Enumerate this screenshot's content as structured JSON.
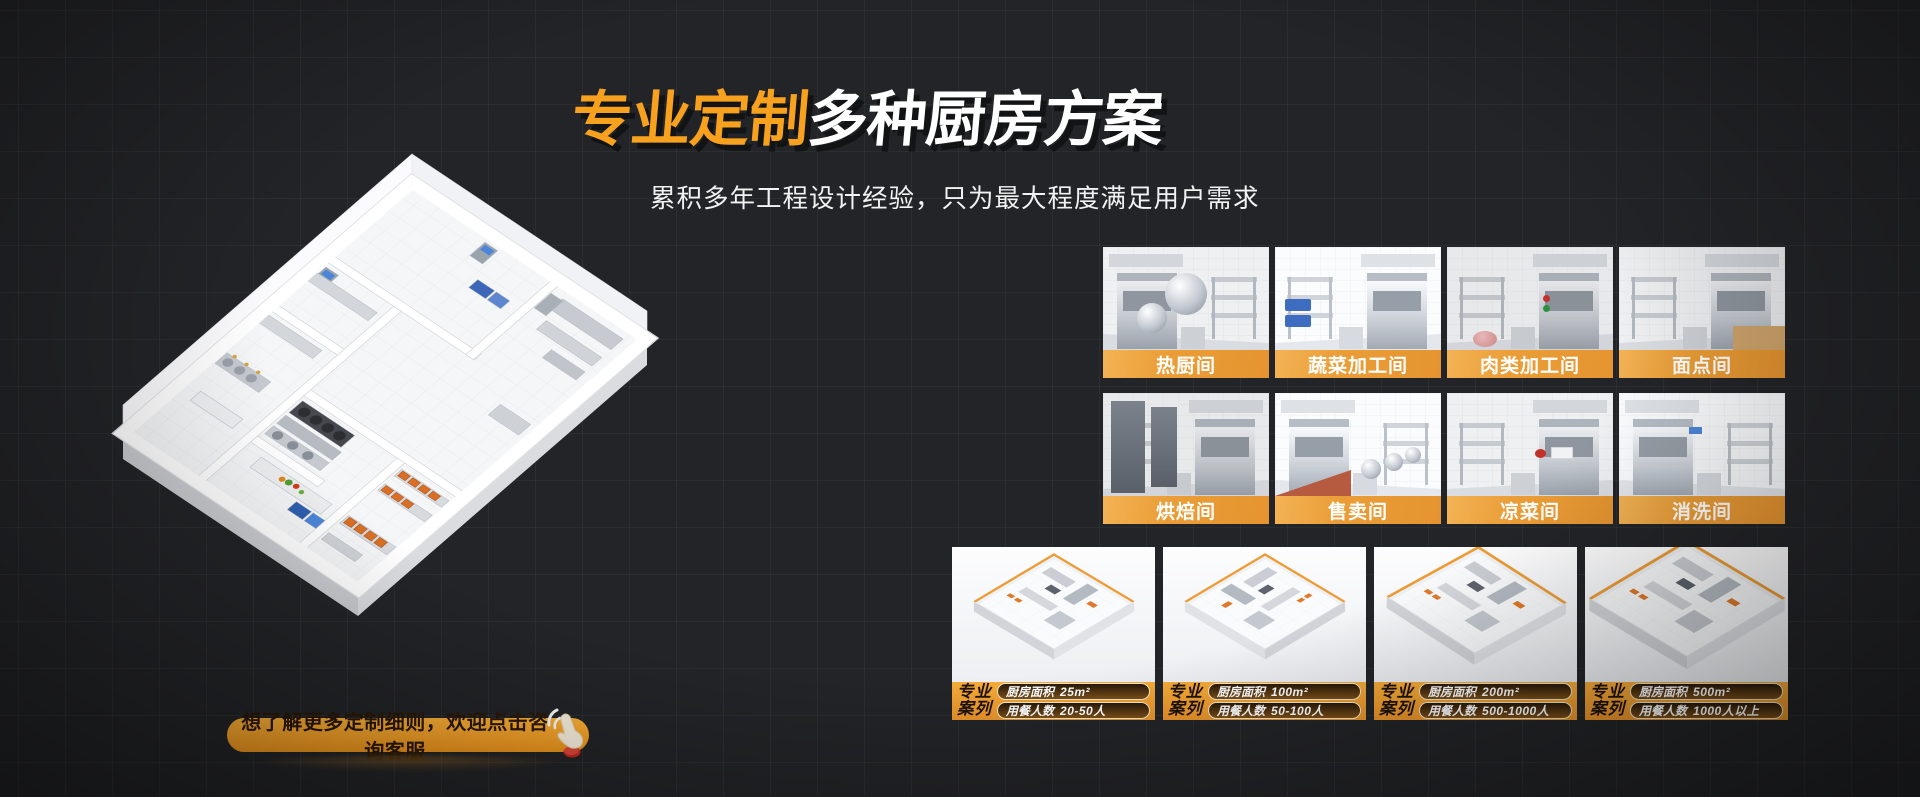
{
  "hero": {
    "title_highlight": "专业定制",
    "title_rest": "多种厨房方案",
    "subtitle": "累积多年工程设计经验，只为最大程度满足用户需求"
  },
  "room_tiles": {
    "row1": [
      {
        "label": "热厨间"
      },
      {
        "label": "蔬菜加工间"
      },
      {
        "label": "肉类加工间"
      },
      {
        "label": "面点间"
      }
    ],
    "row2": [
      {
        "label": "烘焙间"
      },
      {
        "label": "售卖间"
      },
      {
        "label": "凉菜间"
      },
      {
        "label": "消洗间"
      }
    ]
  },
  "cases": {
    "badge_line1": "专业",
    "badge_line2": "案列",
    "items": [
      {
        "area_label": "厨房面积",
        "area_value": "25m²",
        "diners_label": "用餐人数",
        "diners_value": "20-50人"
      },
      {
        "area_label": "厨房面积",
        "area_value": "100m²",
        "diners_label": "用餐人数",
        "diners_value": "50-100人"
      },
      {
        "area_label": "厨房面积",
        "area_value": "200m²",
        "diners_label": "用餐人数",
        "diners_value": "500-1000人"
      },
      {
        "area_label": "厨房面积",
        "area_value": "500m²",
        "diners_label": "用餐人数",
        "diners_value": "1000人以上"
      }
    ]
  },
  "cta": {
    "label": "想了解更多定制细则，欢迎点击咨询客服"
  },
  "colors": {
    "background": "#232427",
    "accent_orange": "#F7A11F",
    "caption_orange": "#E89A32",
    "footer_orange": "#EF9E2C",
    "cta_text": "#2A1804",
    "pill_border": "#F3E7C9",
    "title_white": "#FFFFFF"
  }
}
